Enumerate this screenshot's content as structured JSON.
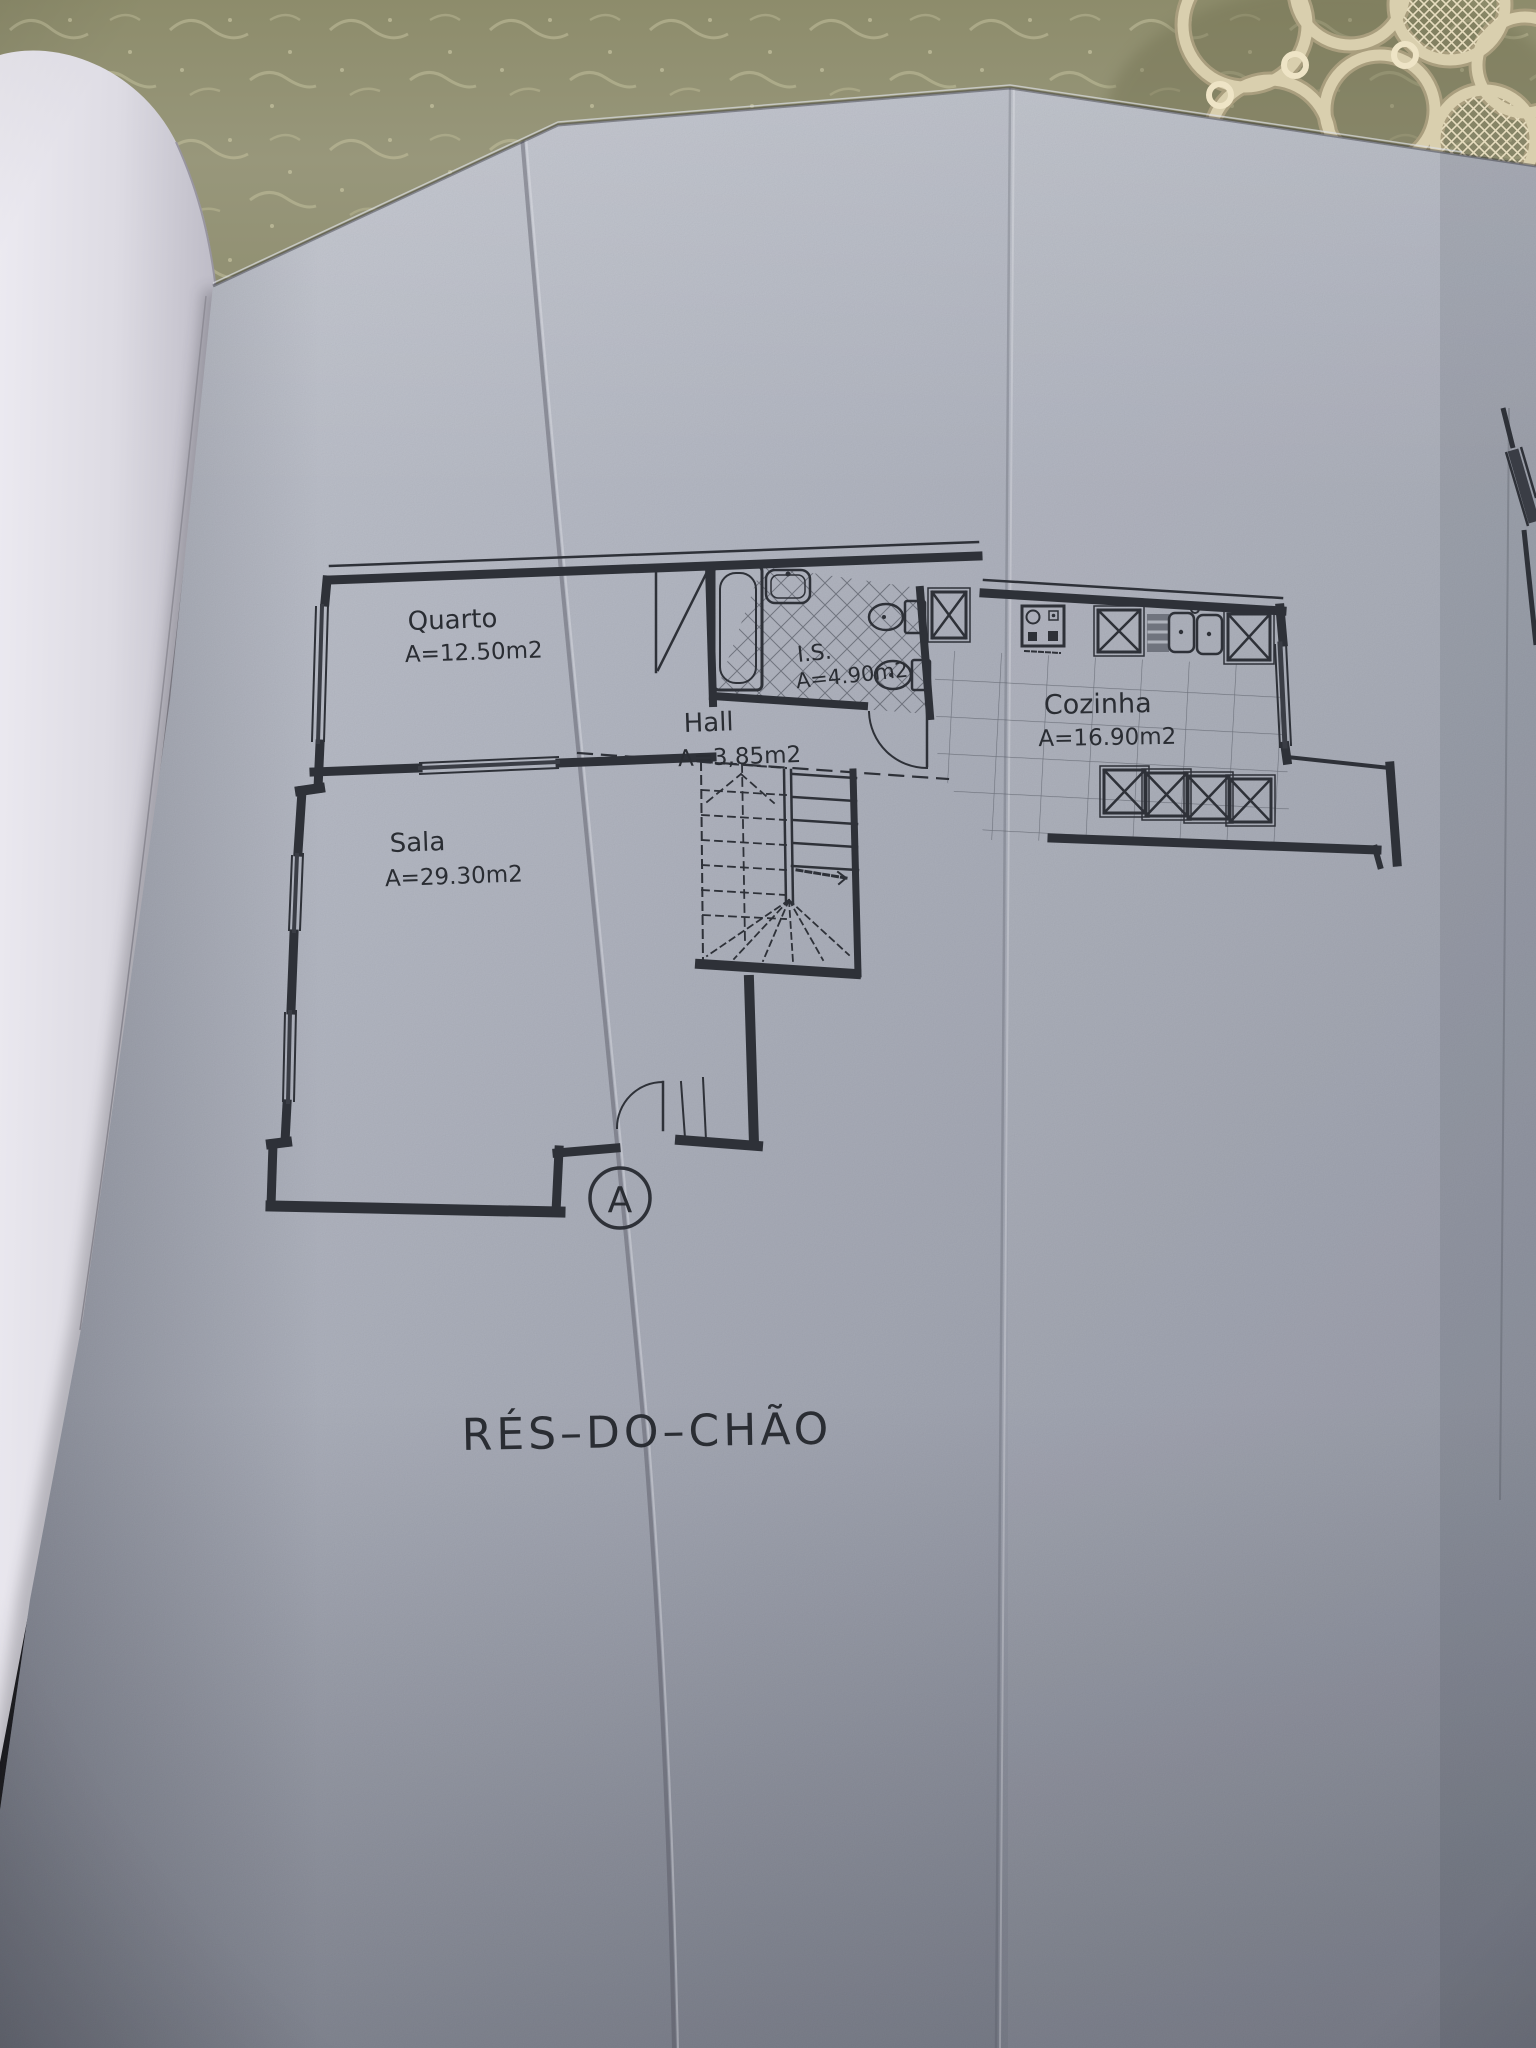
{
  "scene": {
    "description": "Photo of an architectural ground-floor plan on a folded page of an open binder, lying on a table with an olive damask tablecloth and a crocheted lace doily at the top right",
    "tablecloth_color": "#8d8c6b",
    "page_color": "#b3b7c2",
    "ink_color": "#2e3138"
  },
  "plan": {
    "title": "RÉS–DO–CHÃO",
    "entrance_marker": "A",
    "rooms": {
      "quarto": {
        "name": "Quarto",
        "area": "A=12.50m2"
      },
      "sala": {
        "name": "Sala",
        "area": "A=29.30m2"
      },
      "hall": {
        "name": "Hall",
        "area": "A=3,85m2"
      },
      "is": {
        "name": "I.S.",
        "area": "A=4.90m2"
      },
      "cozinha": {
        "name": "Cozinha",
        "area": "A=16.90m2"
      }
    }
  }
}
